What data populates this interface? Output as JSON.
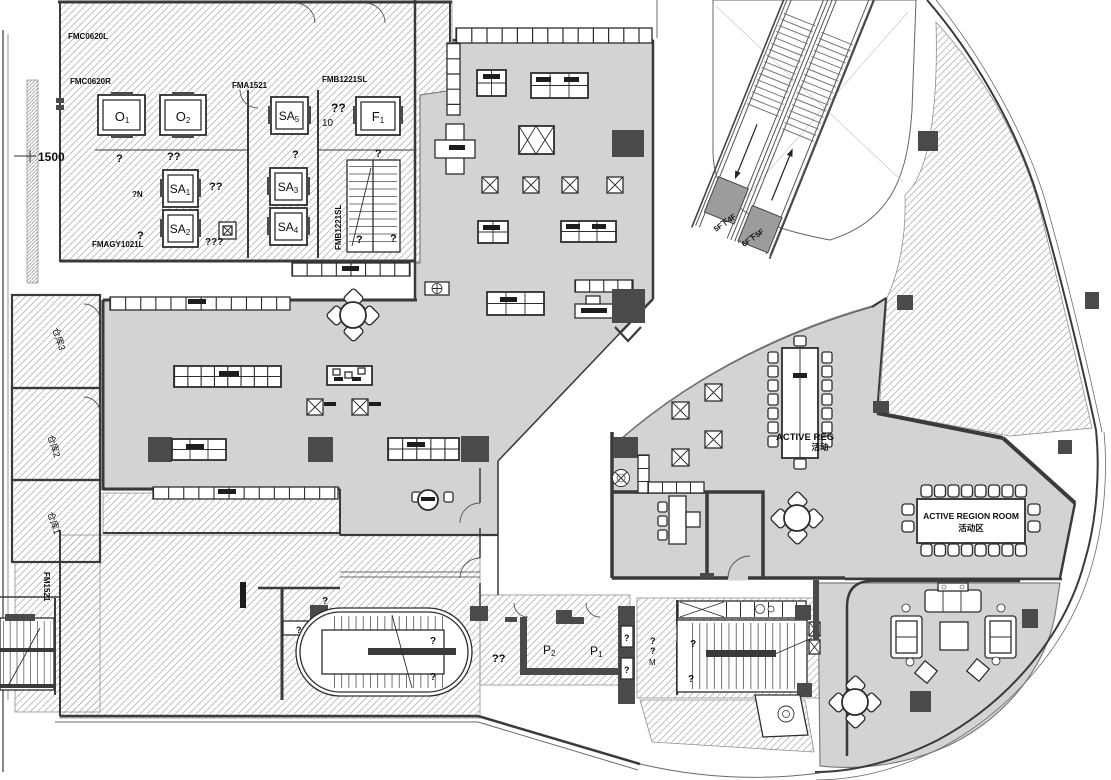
{
  "codes": {
    "fmc0620l": "FMC0620L",
    "fmc0620r": "FMC0620R",
    "fma1521": "FMA1521",
    "fmb1221sl": "FMB1221SL",
    "fmagy1021l": "FMAGY1021L",
    "fmb1221sl_v": "FMB1221SL",
    "fm1521": "FM1521"
  },
  "dims": {
    "d1500": "1500",
    "d10": "10"
  },
  "elevators": {
    "o1": {
      "t": "O",
      "s": "1"
    },
    "o2": {
      "t": "O",
      "s": "2"
    },
    "sa5": {
      "t": "SA",
      "s": "5"
    },
    "f1": {
      "t": "F",
      "s": "1"
    },
    "sa1": {
      "t": "SA",
      "s": "1"
    },
    "sa3": {
      "t": "SA",
      "s": "3"
    },
    "sa2": {
      "t": "SA",
      "s": "2"
    },
    "sa4": {
      "t": "SA",
      "s": "4"
    }
  },
  "pits": {
    "p2": {
      "t": "P",
      "s": "2"
    },
    "p1": {
      "t": "P",
      "s": "1"
    }
  },
  "storage": {
    "s3": "仓库3",
    "s2": "仓库2",
    "s1": "仓库1"
  },
  "escalators": {
    "down": "5F下4F",
    "up": "6F下5F"
  },
  "rooms": {
    "active_en": "ACTIVE REGION ROOM",
    "active_cn": "活动区",
    "activez_en": "ACTIVE REG",
    "activez_cn": "活动"
  },
  "marks": {
    "m1": "??",
    "m2": "10",
    "m3": "?",
    "m4": "??",
    "m5": "?",
    "m6": "?",
    "m7": "?N",
    "m8": "??",
    "m9": "?",
    "m10": "???",
    "m11": "?",
    "m12": "?",
    "m13": "?",
    "m14": "?",
    "m15": "?",
    "m16": "?",
    "m17": "??",
    "m18": "?",
    "m19": "?",
    "m20": "?",
    "m21": "?",
    "m22": "M",
    "m23": "?",
    "m24": "?"
  }
}
